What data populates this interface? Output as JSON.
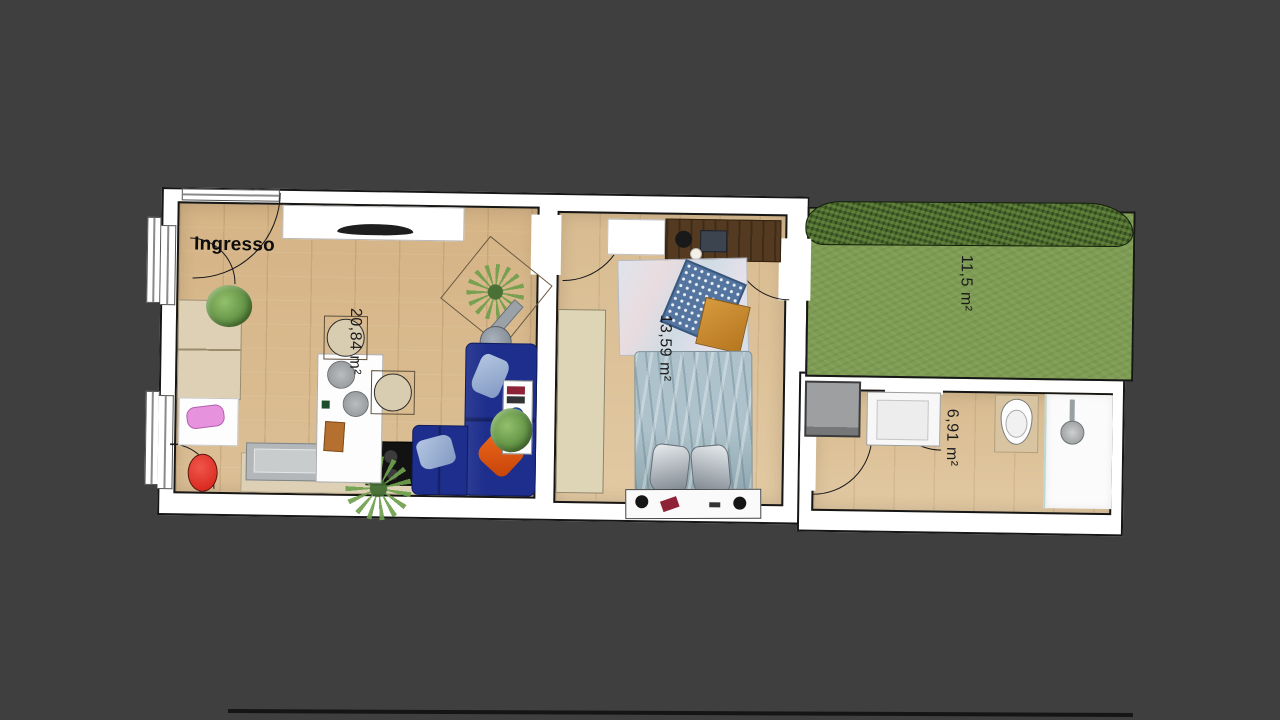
{
  "view": {
    "background_color": "#3f3f3f"
  },
  "plan": {
    "labels": {
      "entrance": "Ingresso",
      "living_kitchen_area": "20,84 m²",
      "bedroom_area": "13,59 m²",
      "garden_area": "11,5 m²",
      "bathroom_area": "6,91 m²"
    },
    "colors": {
      "wall_fill": "#ffffff",
      "wall_line": "#161616",
      "wood_floor": "#d9ba8e",
      "wood_floor_light": "#ddc29a",
      "grass": "#7e9c53",
      "hedge": "#48662c",
      "sofa_blue": "#1d2e8c",
      "pillow_light_blue": "#9db3d6",
      "pillow_orange": "#dd5413",
      "cabinet_beige": "#ded0b4",
      "desk_brown": "#543a20",
      "bed_blue": "#adc2cb",
      "appliance_gray": "#9d9fa0"
    },
    "rooms": [
      {
        "name": "living-kitchen",
        "area": "20,84 m²"
      },
      {
        "name": "bedroom",
        "area": "13,59 m²"
      },
      {
        "name": "garden",
        "area": "11,5 m²"
      },
      {
        "name": "bathroom",
        "area": "6,91 m²"
      }
    ],
    "furniture_inventory": [
      "tv-sideboard",
      "tv",
      "kitchen-cabinets",
      "kitchen-sink",
      "stove",
      "kitchen-island",
      "cutting-board",
      "bar-stools",
      "dining-chairs",
      "l-shaped-sofa",
      "sofa-pillows",
      "side-table",
      "floor-lamp",
      "potted-plants",
      "double-bed",
      "bed-pillows",
      "headboard-shelf",
      "reading-lamps",
      "wardrobe",
      "desk",
      "laptop",
      "desk-chair",
      "area-rug",
      "play-mat",
      "washing-machine",
      "bathroom-sink",
      "toilet",
      "shower",
      "lawn",
      "hedge"
    ]
  }
}
